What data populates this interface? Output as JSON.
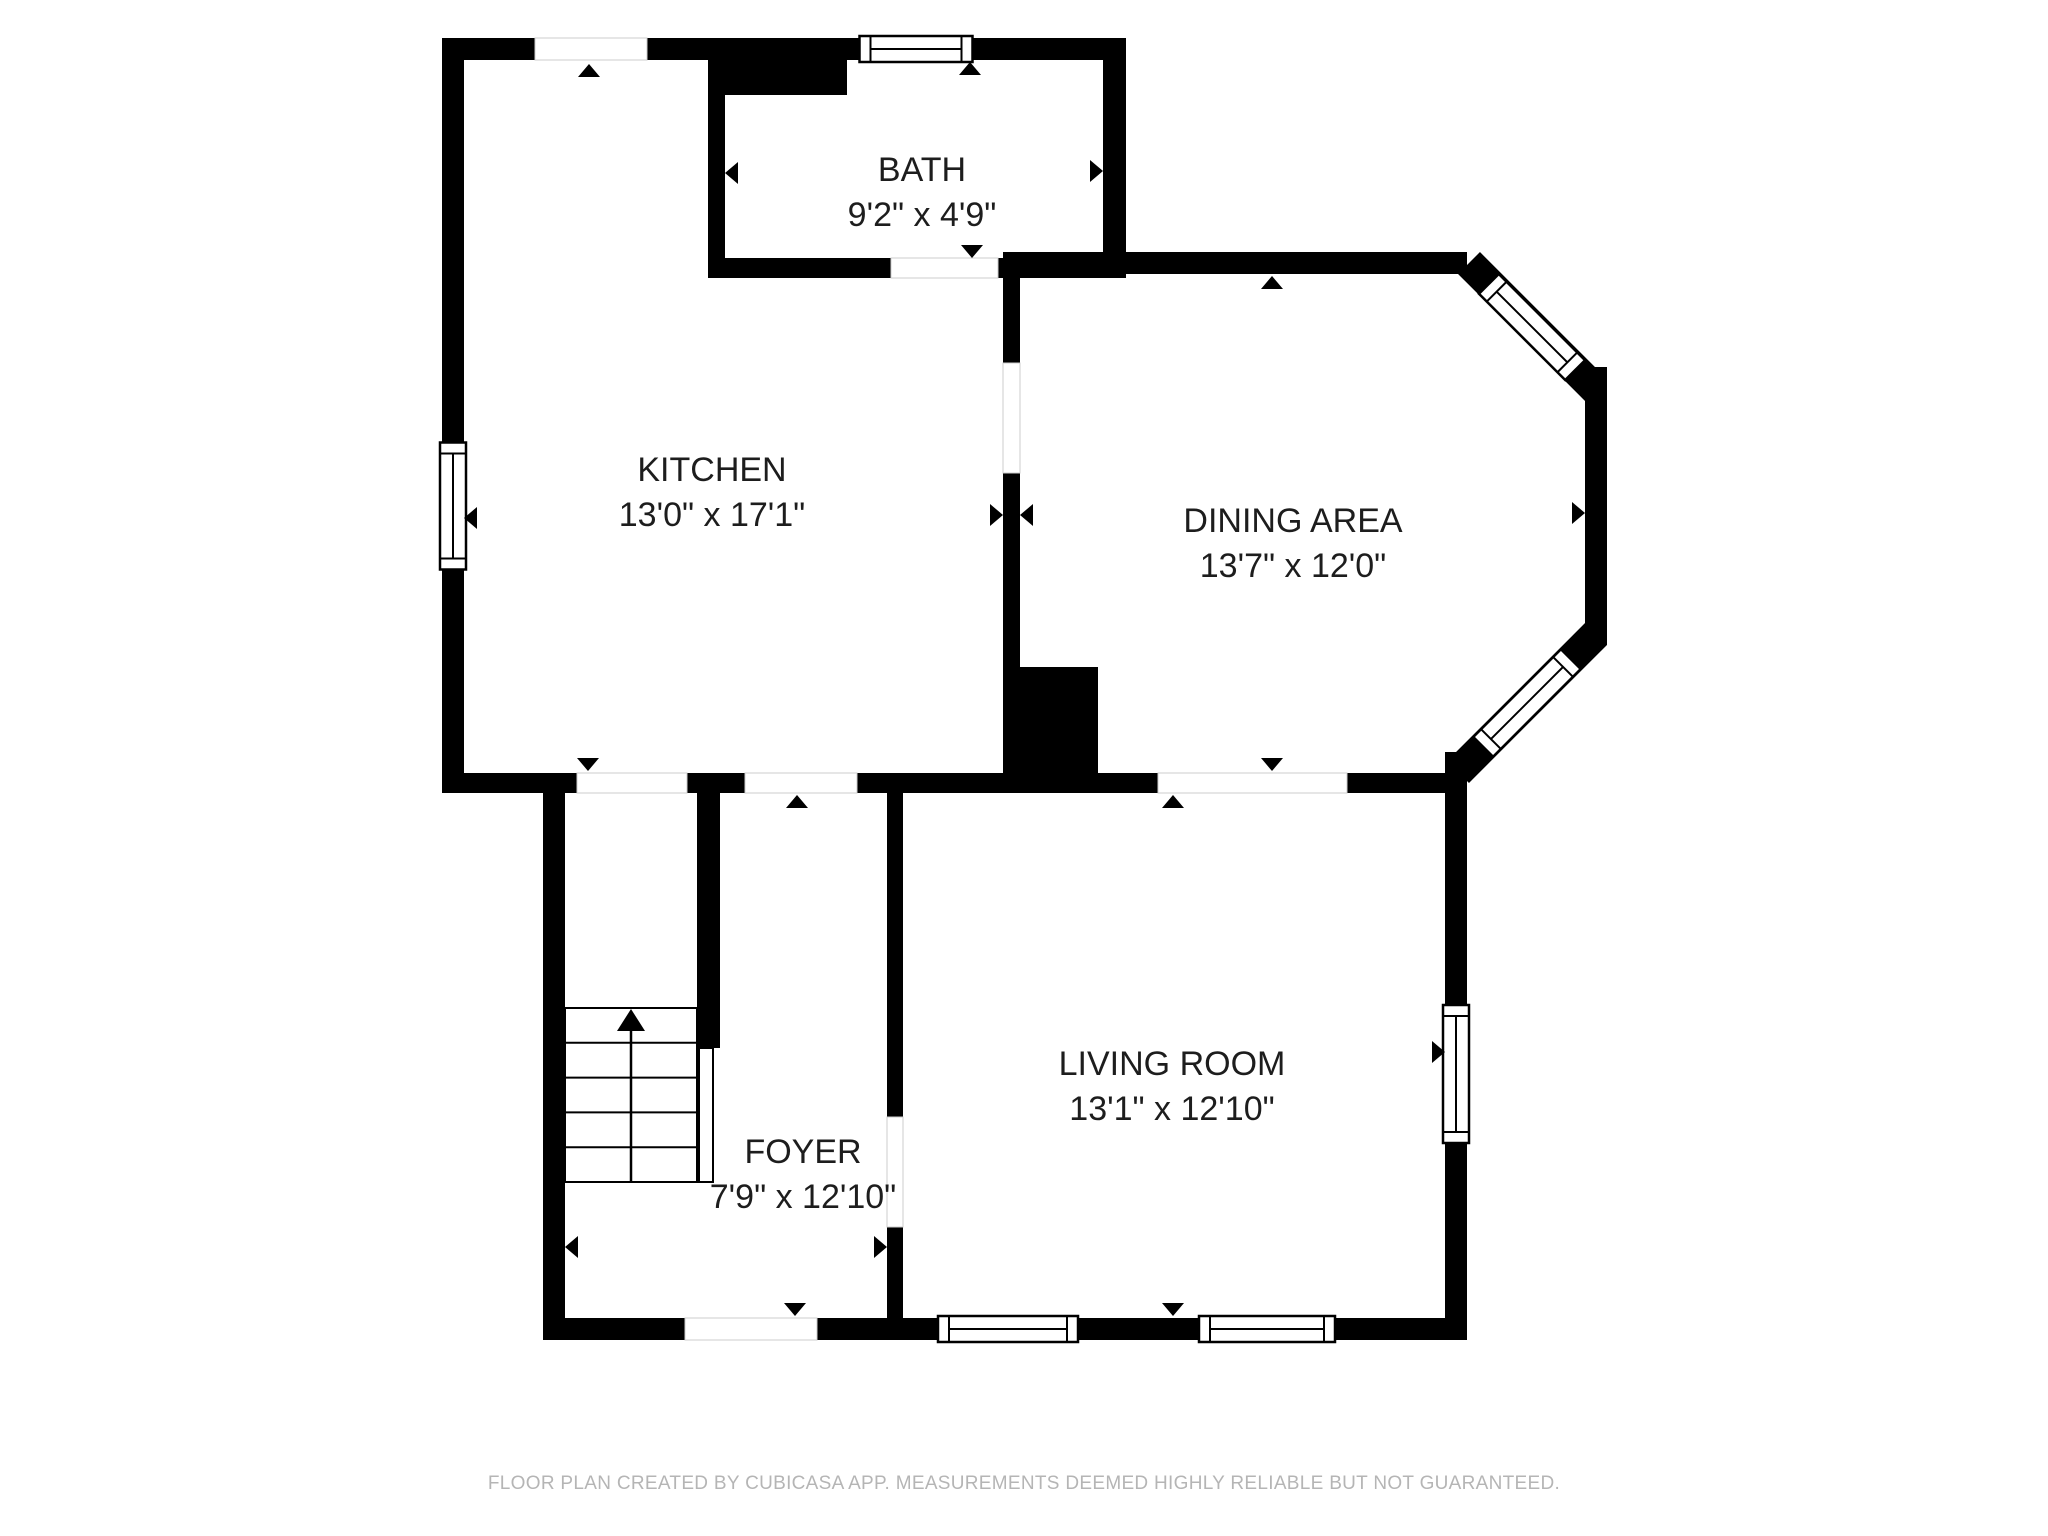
{
  "footer": {
    "text": "FLOOR PLAN CREATED BY CUBICASA APP. MEASUREMENTS DEEMED HIGHLY RELIABLE BUT NOT GUARANTEED.",
    "color": "#b5b5b5"
  },
  "colors": {
    "wall": "#000000",
    "label_text": "#1d1d1d",
    "opening_edge": "#cccccc",
    "window_fill": "#ffffff"
  },
  "rooms": [
    {
      "id": "bath",
      "name": "BATH",
      "dimensions": "9'2\" x 4'9\"",
      "label_x": 922,
      "label_y": 170
    },
    {
      "id": "kitchen",
      "name": "KITCHEN",
      "dimensions": "13'0\" x 17'1\"",
      "label_x": 712,
      "label_y": 470
    },
    {
      "id": "dining",
      "name": "DINING AREA",
      "dimensions": "13'7\" x 12'0\"",
      "label_x": 1293,
      "label_y": 521
    },
    {
      "id": "living",
      "name": "LIVING ROOM",
      "dimensions": "13'1\" x 12'10\"",
      "label_x": 1172,
      "label_y": 1064
    },
    {
      "id": "foyer",
      "name": "FOYER",
      "dimensions": "7'9\" x 12'10\"",
      "label_x": 803,
      "label_y": 1152
    }
  ],
  "plan": {
    "walls": [
      {
        "name": "top-wall-a",
        "x": 442,
        "y": 38,
        "w": 93,
        "h": 22
      },
      {
        "name": "top-wall-b",
        "x": 647,
        "y": 38,
        "w": 213,
        "h": 22
      },
      {
        "name": "top-wall-c",
        "x": 973,
        "y": 38,
        "w": 153,
        "h": 22
      },
      {
        "name": "left-wall-upper",
        "x": 442,
        "y": 38,
        "w": 22,
        "h": 405
      },
      {
        "name": "left-wall-lower",
        "x": 442,
        "y": 570,
        "w": 22,
        "h": 223
      },
      {
        "name": "bath-east-wall",
        "x": 1103,
        "y": 38,
        "w": 23,
        "h": 236
      },
      {
        "name": "bath-west-mass",
        "x": 708,
        "y": 60,
        "w": 139,
        "h": 35
      },
      {
        "name": "bath-west-wall",
        "x": 708,
        "y": 95,
        "w": 17,
        "h": 183
      },
      {
        "name": "bath-south-wall-a",
        "x": 708,
        "y": 258,
        "w": 183,
        "h": 20
      },
      {
        "name": "bath-south-wall-b",
        "x": 998,
        "y": 258,
        "w": 128,
        "h": 20
      },
      {
        "name": "dining-top-wall",
        "x": 1003,
        "y": 252,
        "w": 464,
        "h": 22
      },
      {
        "name": "divider-upper",
        "x": 1003,
        "y": 273,
        "w": 17,
        "h": 90
      },
      {
        "name": "divider-lower",
        "x": 1003,
        "y": 473,
        "w": 17,
        "h": 194
      },
      {
        "name": "divider-chunk",
        "x": 1003,
        "y": 667,
        "w": 95,
        "h": 126
      },
      {
        "name": "south-band-a",
        "x": 442,
        "y": 773,
        "w": 135,
        "h": 20
      },
      {
        "name": "south-band-b",
        "x": 687,
        "y": 773,
        "w": 58,
        "h": 20
      },
      {
        "name": "south-band-c",
        "x": 857,
        "y": 773,
        "w": 301,
        "h": 20
      },
      {
        "name": "south-band-d",
        "x": 1347,
        "y": 773,
        "w": 120,
        "h": 20
      },
      {
        "name": "bay-east-wall",
        "x": 1585,
        "y": 367,
        "w": 22,
        "h": 278
      },
      {
        "name": "living-east-upper",
        "x": 1445,
        "y": 752,
        "w": 22,
        "h": 253
      },
      {
        "name": "living-east-lower",
        "x": 1445,
        "y": 1143,
        "w": 22,
        "h": 197
      },
      {
        "name": "foyer-left-wall",
        "x": 543,
        "y": 793,
        "w": 22,
        "h": 525
      },
      {
        "name": "stair-stub-wall",
        "x": 697,
        "y": 793,
        "w": 23,
        "h": 255
      },
      {
        "name": "foyer-right-upper",
        "x": 887,
        "y": 793,
        "w": 16,
        "h": 324
      },
      {
        "name": "foyer-right-lower",
        "x": 887,
        "y": 1227,
        "w": 16,
        "h": 91
      },
      {
        "name": "bottom-wall-a",
        "x": 543,
        "y": 1318,
        "w": 142,
        "h": 22
      },
      {
        "name": "bottom-wall-b",
        "x": 817,
        "y": 1318,
        "w": 121,
        "h": 22
      },
      {
        "name": "bottom-wall-c",
        "x": 1078,
        "y": 1318,
        "w": 121,
        "h": 22
      },
      {
        "name": "bottom-wall-d",
        "x": 1335,
        "y": 1318,
        "w": 132,
        "h": 22
      }
    ],
    "diagonal_walls": [
      {
        "name": "bay-ne-diagonal-wall",
        "x1": 1469,
        "y1": 263,
        "x2": 1596,
        "y2": 390,
        "width": 31
      },
      {
        "name": "bay-se-diagonal-wall",
        "x1": 1596,
        "y1": 634,
        "x2": 1458,
        "y2": 772,
        "width": 31
      }
    ],
    "openings": [
      {
        "name": "kitchen-top-opening",
        "x": 535,
        "y": 38,
        "w": 112,
        "h": 22
      },
      {
        "name": "kitchen-dining-doorway",
        "x": 1003,
        "y": 363,
        "w": 17,
        "h": 110
      },
      {
        "name": "bath-doorway",
        "x": 891,
        "y": 258,
        "w": 107,
        "h": 20
      },
      {
        "name": "kitchen-foyer-opening-1",
        "x": 577,
        "y": 773,
        "w": 110,
        "h": 20
      },
      {
        "name": "kitchen-foyer-opening-2",
        "x": 745,
        "y": 773,
        "w": 112,
        "h": 20
      },
      {
        "name": "dining-living-opening",
        "x": 1158,
        "y": 773,
        "w": 189,
        "h": 20
      },
      {
        "name": "foyer-living-doorway",
        "x": 887,
        "y": 1117,
        "w": 16,
        "h": 110
      },
      {
        "name": "foyer-entry-opening",
        "x": 685,
        "y": 1318,
        "w": 132,
        "h": 22
      }
    ],
    "windows": [
      {
        "name": "bath-top-window",
        "cx": 916,
        "cy": 49,
        "length": 113,
        "thickness": 26,
        "angle": 0
      },
      {
        "name": "kitchen-left-window",
        "cx": 453,
        "cy": 506,
        "length": 127,
        "thickness": 26,
        "angle": 90
      },
      {
        "name": "living-east-window",
        "cx": 1456,
        "cy": 1074,
        "length": 138,
        "thickness": 26,
        "angle": 90
      },
      {
        "name": "living-south-window-1",
        "cx": 1008,
        "cy": 1329,
        "length": 140,
        "thickness": 26,
        "angle": 0
      },
      {
        "name": "living-south-window-2",
        "cx": 1267,
        "cy": 1329,
        "length": 136,
        "thickness": 26,
        "angle": 0
      },
      {
        "name": "bay-ne-window",
        "cx": 1532,
        "cy": 327,
        "length": 122,
        "thickness": 28,
        "angle": 45
      },
      {
        "name": "bay-se-window",
        "cx": 1527,
        "cy": 703,
        "length": 124,
        "thickness": 28,
        "angle": -45
      }
    ],
    "arrows": [
      {
        "name": "kitchen-top-opening-arrow",
        "x": 589,
        "y": 64,
        "dir": "up"
      },
      {
        "name": "bath-window-arrow",
        "x": 970,
        "y": 62,
        "dir": "up"
      },
      {
        "name": "bath-west-arrow",
        "x": 725,
        "y": 173,
        "dir": "left"
      },
      {
        "name": "bath-east-arrow",
        "x": 1103,
        "y": 171,
        "dir": "right"
      },
      {
        "name": "bath-door-arrow",
        "x": 972,
        "y": 258,
        "dir": "down"
      },
      {
        "name": "dining-top-arrow",
        "x": 1272,
        "y": 276,
        "dir": "up"
      },
      {
        "name": "dining-bay-arrow",
        "x": 1585,
        "y": 513,
        "dir": "right"
      },
      {
        "name": "divider-door-arrow-west",
        "x": 1003,
        "y": 515,
        "dir": "right"
      },
      {
        "name": "divider-door-arrow-east",
        "x": 1020,
        "y": 515,
        "dir": "left"
      },
      {
        "name": "kitchen-foyer-arrow-1",
        "x": 588,
        "y": 771,
        "dir": "down"
      },
      {
        "name": "kitchen-foyer-arrow-2",
        "x": 797,
        "y": 795,
        "dir": "up"
      },
      {
        "name": "dining-living-arrow-down",
        "x": 1272,
        "y": 771,
        "dir": "down"
      },
      {
        "name": "dining-living-arrow-up",
        "x": 1173,
        "y": 795,
        "dir": "up"
      },
      {
        "name": "foyer-left-arrow",
        "x": 565,
        "y": 1247,
        "dir": "left"
      },
      {
        "name": "foyer-right-arrow",
        "x": 887,
        "y": 1247,
        "dir": "right"
      },
      {
        "name": "living-east-window-arrow",
        "x": 1445,
        "y": 1052,
        "dir": "right"
      },
      {
        "name": "foyer-entry-arrow",
        "x": 795,
        "y": 1316,
        "dir": "down"
      },
      {
        "name": "living-south-arrow",
        "x": 1173,
        "y": 1316,
        "dir": "down"
      },
      {
        "name": "kitchen-window-arrow",
        "x": 464,
        "y": 518,
        "dir": "left"
      }
    ],
    "stairs": {
      "name": "foyer-stairs",
      "x": 565,
      "y": 1008,
      "w": 132,
      "h": 174,
      "treads": 5,
      "stem_x": 631,
      "arrow": {
        "apex_x": 631,
        "apex_y": 1009,
        "base_y": 1031,
        "half_w": 14
      },
      "rail": {
        "x": 699,
        "y": 1048,
        "w": 14,
        "h": 134
      }
    }
  }
}
